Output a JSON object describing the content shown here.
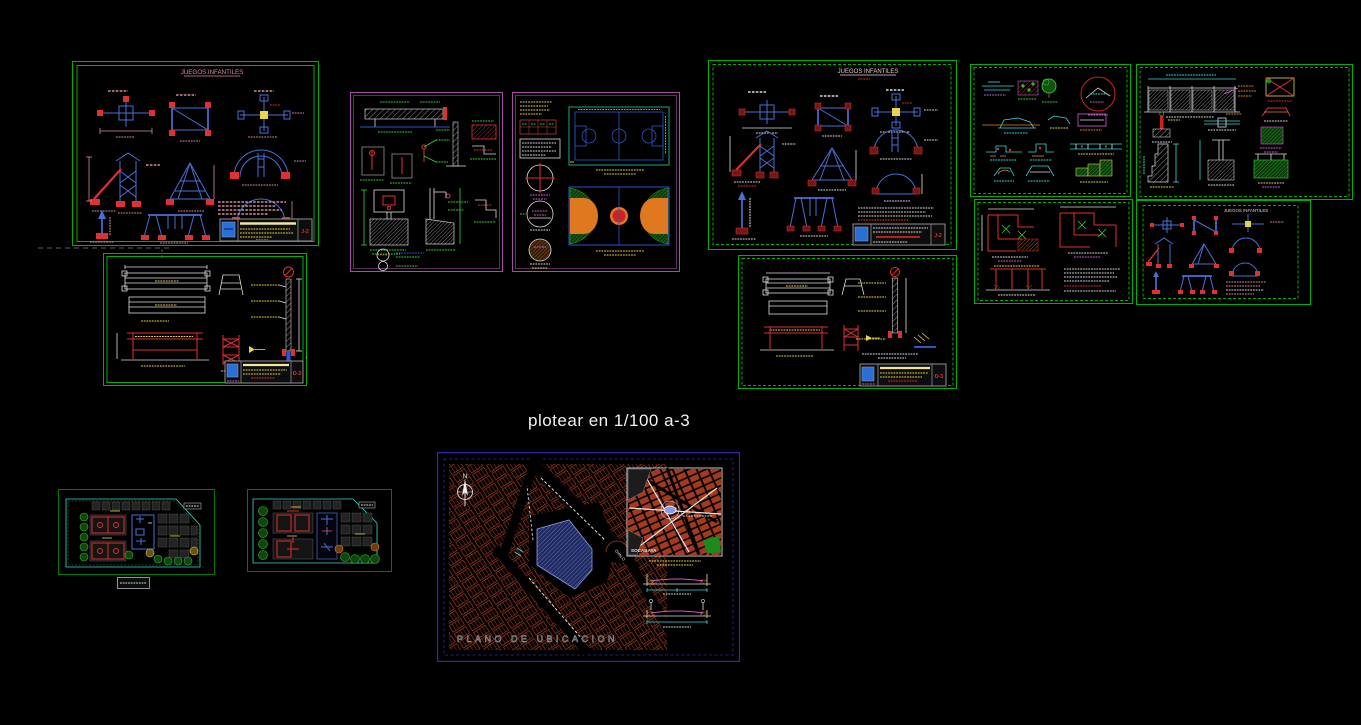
{
  "app": {
    "background": "#000000"
  },
  "annotations": {
    "plot_note": "plotear en 1/100 a-3"
  },
  "sheets": {
    "juegos_left": {
      "title": "JUEGOS INFANTILES",
      "code": "J-2"
    },
    "juegos_right": {
      "title": "JUEGOS INFANTILES",
      "code": "J-2"
    },
    "juegos_mini": {
      "title": "JUEGOS INFANTILES"
    },
    "bench_left": {
      "code": "D-3"
    },
    "bench_right": {
      "code": "D-3"
    },
    "ubicacion": {
      "title": "PLANO  DE  UBICACION",
      "inset_label": "SOCABAYA",
      "compass": "N",
      "roundabout_label": "OVALO"
    }
  },
  "colors": {
    "border_green": "#00b000",
    "border_magenta": "#a64ca6",
    "border_navy": "#2b2ba8",
    "cad_blue": "#4a6fd4",
    "cad_red": "#e03030",
    "dim_pink": "#d489a0",
    "label_green": "#35d435",
    "label_yellow": "#e8d44d",
    "label_cyan": "#3dd8d8",
    "label_magenta": "#d060d0",
    "street_red": "#a33a1e",
    "lot_blue": "#6c7fd8",
    "court_green": "#1d8a1d",
    "court_orange": "#e07820",
    "logo_blue": "#2a6fd6"
  }
}
